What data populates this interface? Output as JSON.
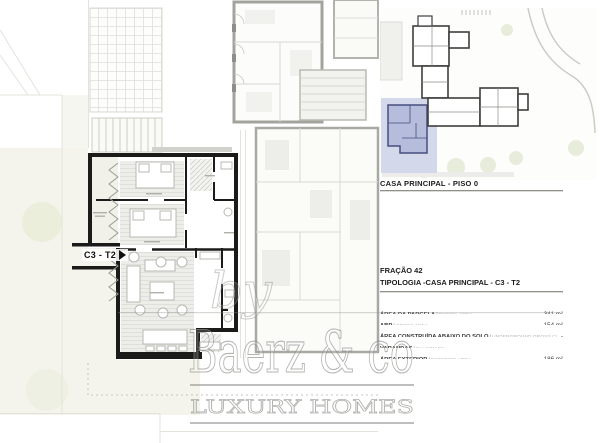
{
  "key_plan": {
    "caption": "CASA PRINCIPAL - PISO 0",
    "highlight_fill": "#b6bcdc",
    "highlight_border": "#474f7e",
    "highlight_area_fill": "#d3d8ea"
  },
  "info": {
    "fraction": "FRAÇÃO 42",
    "typology": "TIPOLOGIA -CASA PRINCIPAL - C3 - T2"
  },
  "area_table": {
    "separator": "|",
    "rows": [
      {
        "label_pt": "ÁREA DA PARCELA",
        "label_en": "PARCEL AREA",
        "value": "341 m²"
      },
      {
        "label_pt": "ABP",
        "label_en": "GROSS AREA",
        "value": "154 m²"
      },
      {
        "label_pt": "ÁREA CONSTRUÍDA ABAIXO DO SOLO",
        "label_en": "UNDERGROUND GROSS CONSTRUCTION AREA",
        "value": "-"
      },
      {
        "label_pt": "VARANDAS",
        "label_en": "BALCONIES",
        "value": "-"
      },
      {
        "label_pt": "ÁREA EXTERIOR",
        "label_en": "EXTERIOR AREA",
        "value": "186 m²"
      }
    ]
  },
  "plan": {
    "unit_label": "C3 - T2"
  },
  "watermark": {
    "by": "by",
    "brand": "Baerz & co",
    "tagline": "LUXURY HOMES"
  },
  "colors": {
    "wall_black": "#1b1b1a",
    "adjacent_gray": "#a3a39e",
    "garden_green": "#eaeedb",
    "ground_beige": "#f4f4ec",
    "watermark_gray": "#8b8b87"
  }
}
